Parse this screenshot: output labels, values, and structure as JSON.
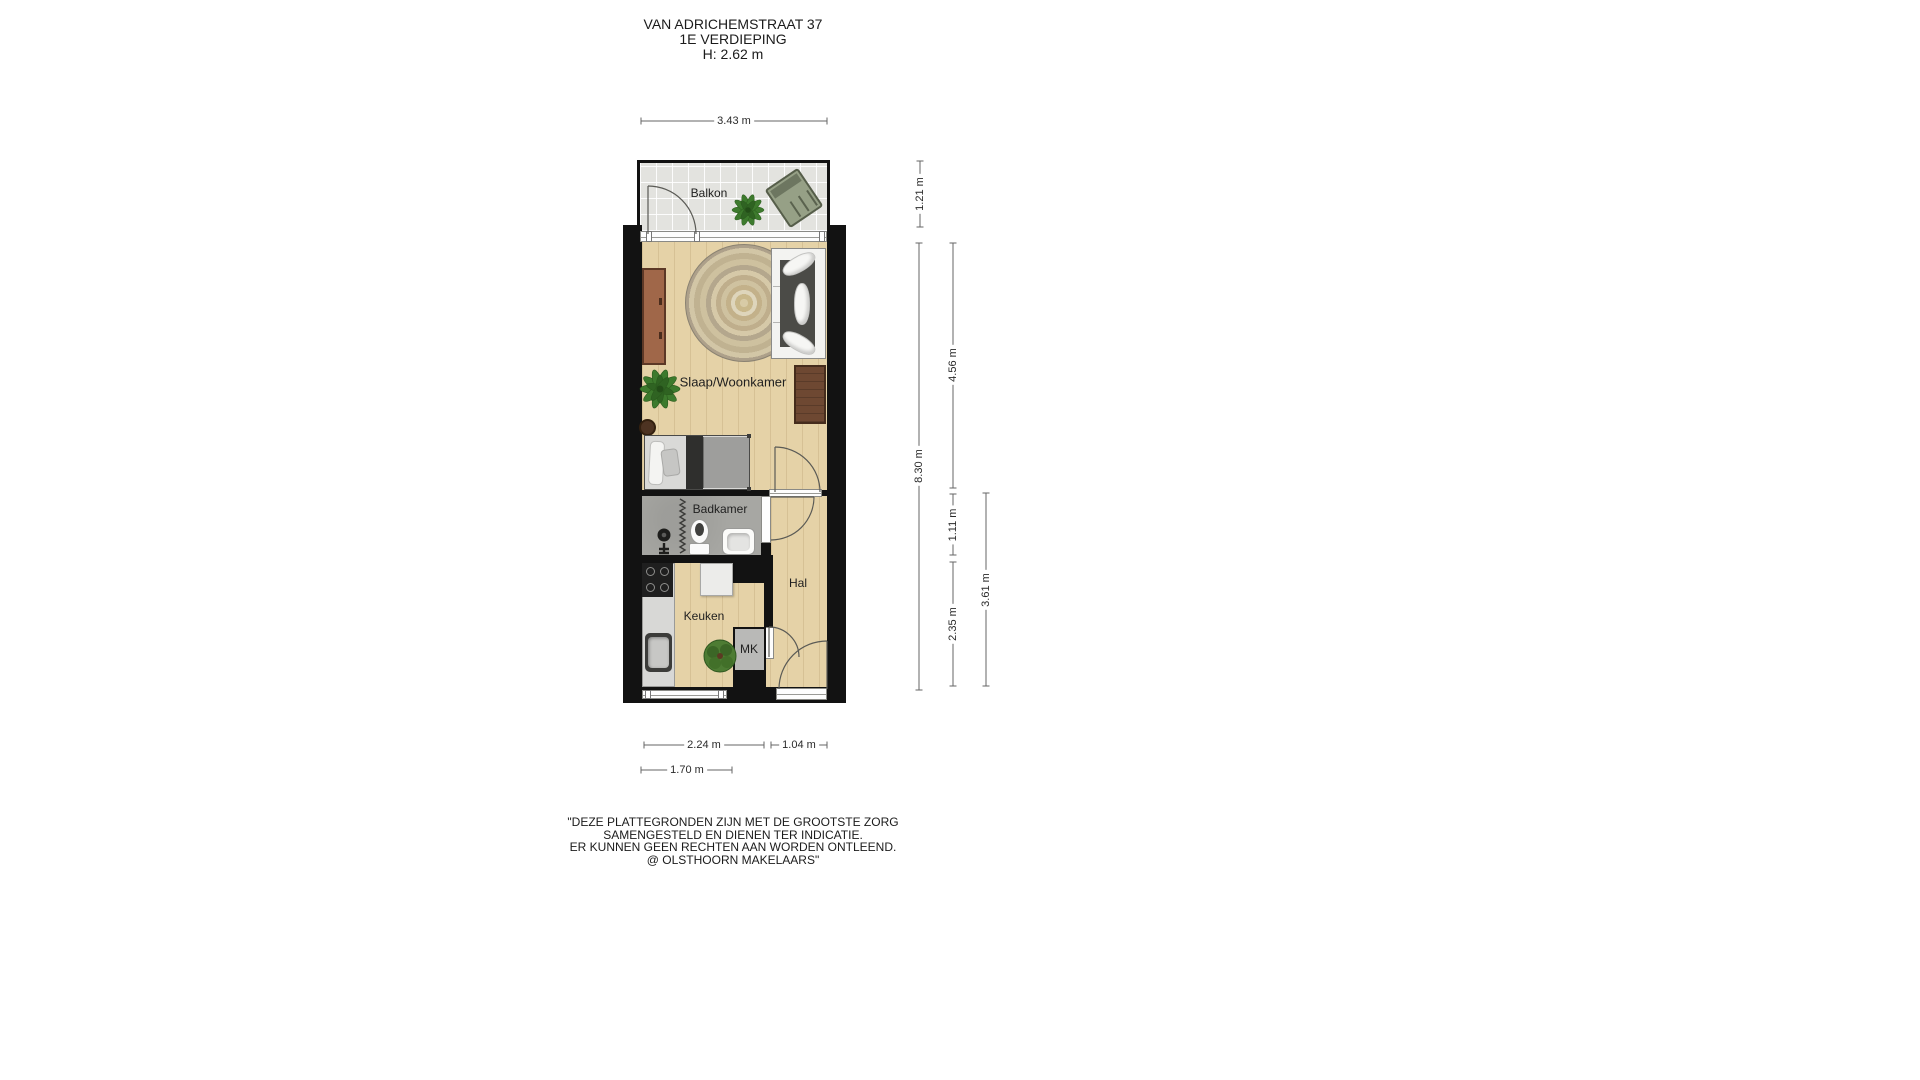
{
  "title": {
    "address": "VAN ADRICHEMSTRAAT 37",
    "floor": "1E VERDIEPING",
    "ceiling_height": "H: 2.62 m"
  },
  "rooms": {
    "balkon": "Balkon",
    "slaapwoonkamer": "Slaap/Woonkamer",
    "badkamer": "Badkamer",
    "hal": "Hal",
    "keuken": "Keuken",
    "mk": "MK"
  },
  "dimensions": {
    "balkon_width": {
      "label": "3.43 m",
      "meters": 3.43,
      "orientation": "horizontal"
    },
    "balkon_depth": {
      "label": "1.21 m",
      "meters": 1.21,
      "orientation": "vertical"
    },
    "total_depth": {
      "label": "8.30 m",
      "meters": 8.3,
      "orientation": "vertical"
    },
    "woonkamer_depth": {
      "label": "4.56 m",
      "meters": 4.56,
      "orientation": "vertical"
    },
    "badkamer_depth": {
      "label": "1.11 m",
      "meters": 1.11,
      "orientation": "vertical"
    },
    "keuken_depth": {
      "label": "2.35 m",
      "meters": 2.35,
      "orientation": "vertical"
    },
    "hal_depth": {
      "label": "3.61 m",
      "meters": 3.61,
      "orientation": "vertical"
    },
    "keuken_width": {
      "label": "2.24 m",
      "meters": 2.24,
      "orientation": "horizontal"
    },
    "entree_width": {
      "label": "1.04 m",
      "meters": 1.04,
      "orientation": "horizontal"
    },
    "aanrecht_width": {
      "label": "1.70 m",
      "meters": 1.7,
      "orientation": "horizontal"
    }
  },
  "disclaimer": {
    "lines": [
      "\"DEZE PLATTEGRONDEN ZIJN MET DE GROOTSTE ZORG",
      "SAMENGESTELD EN DIENEN TER INDICATIE.",
      "ER KUNNEN GEEN RECHTEN AAN WORDEN ONTLEEND.",
      "@ OLSTHOORN MAKELAARS\""
    ]
  },
  "palette": {
    "wall": "#121212",
    "wood_floor": "#e5d2a7",
    "balcony_tile": "#e3e3df",
    "bathroom_floor": "#a7a7a3",
    "plant_green": "#3d7a2d",
    "armchair_green": "#96a086",
    "furniture_brown": "#6e4832",
    "sideboard_brown": "#a06749",
    "dimension_line": "#666666"
  }
}
